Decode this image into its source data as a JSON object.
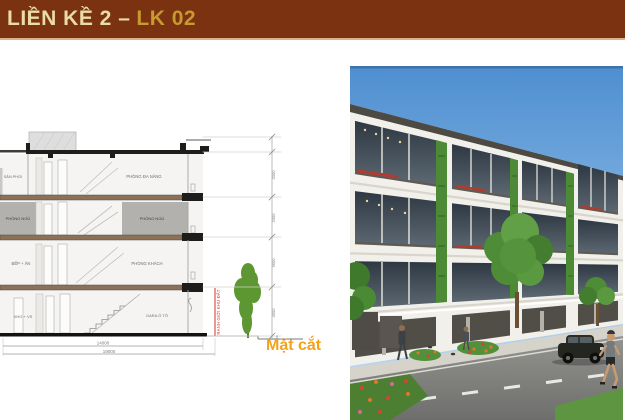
{
  "header": {
    "title_main": "LIỀN KỀ 2 –",
    "title_code": "LK 02"
  },
  "drawing": {
    "caption": "Mặt cắt",
    "boundary_label": "RANH GIỚI KHU ĐẤT",
    "rooms": {
      "attic_left": "SÂN PHƠI",
      "attic_right": "PHÒNG ĐA NĂNG",
      "f2_left": "PHÒNG NGỦ",
      "f2_right": "PHÒNG NGỦ",
      "f1_left": "BẾP + ĂN",
      "f1_right": "PHÒNG KHÁCH",
      "g_left": "KHO + VS",
      "g_right": "GARA Ô TÔ"
    },
    "dims": {
      "width_main": "14000",
      "width_total": "19000",
      "h1": "3300",
      "h2": "3300",
      "h3": "3600",
      "h4": "4500",
      "plinth": "450"
    }
  },
  "colors": {
    "header_bg": "#7b3210",
    "title_light": "#eadcaa",
    "title_gold": "#c8992e",
    "slab_brown": "#8d7156",
    "room_gray": "#b3b1ae",
    "boundary_red": "#d93025",
    "tree_green": "#5d9732",
    "caption_orange": "#f5a21b",
    "sky_blue": "#4e8ed0"
  }
}
